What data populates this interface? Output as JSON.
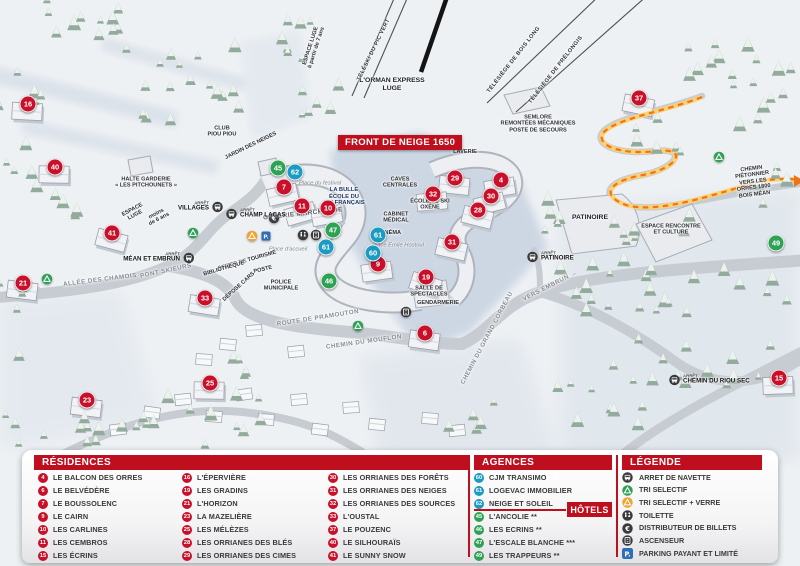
{
  "colors": {
    "red": "#c8102a",
    "blue": "#1b9ac2",
    "green": "#2ea155",
    "header_red": "#bf0f1e",
    "orange_path": "#ee7416",
    "parking_blue": "#2f6db5",
    "icon_dark": "#3a3a3c"
  },
  "map": {
    "banner": "FRONT DE NEIGE 1650",
    "markers": [
      {
        "n": "16",
        "type": "residence",
        "x": 28,
        "y": 104
      },
      {
        "n": "40",
        "type": "residence",
        "x": 55,
        "y": 167
      },
      {
        "n": "41",
        "type": "residence",
        "x": 112,
        "y": 233
      },
      {
        "n": "21",
        "type": "residence",
        "x": 23,
        "y": 283
      },
      {
        "n": "33",
        "type": "residence",
        "x": 205,
        "y": 298
      },
      {
        "n": "23",
        "type": "residence",
        "x": 87,
        "y": 400
      },
      {
        "n": "25",
        "type": "residence",
        "x": 210,
        "y": 383
      },
      {
        "n": "7",
        "type": "residence",
        "x": 284,
        "y": 187
      },
      {
        "n": "11",
        "type": "residence",
        "x": 302,
        "y": 206
      },
      {
        "n": "10",
        "type": "residence",
        "x": 328,
        "y": 208
      },
      {
        "n": "9",
        "type": "residence",
        "x": 378,
        "y": 264
      },
      {
        "n": "19",
        "type": "residence",
        "x": 426,
        "y": 277
      },
      {
        "n": "6",
        "type": "residence",
        "x": 425,
        "y": 333
      },
      {
        "n": "29",
        "type": "residence",
        "x": 455,
        "y": 178
      },
      {
        "n": "32",
        "type": "residence",
        "x": 433,
        "y": 194
      },
      {
        "n": "4",
        "type": "residence",
        "x": 501,
        "y": 180
      },
      {
        "n": "30",
        "type": "residence",
        "x": 491,
        "y": 196
      },
      {
        "n": "28",
        "type": "residence",
        "x": 478,
        "y": 210
      },
      {
        "n": "31",
        "type": "residence",
        "x": 452,
        "y": 242
      },
      {
        "n": "37",
        "type": "residence",
        "x": 639,
        "y": 98
      },
      {
        "n": "15",
        "type": "residence",
        "x": 779,
        "y": 378
      },
      {
        "n": "45",
        "type": "hotel",
        "x": 278,
        "y": 168
      },
      {
        "n": "47",
        "type": "hotel",
        "x": 333,
        "y": 230
      },
      {
        "n": "46",
        "type": "hotel",
        "x": 329,
        "y": 281
      },
      {
        "n": "49",
        "type": "hotel",
        "x": 776,
        "y": 243
      },
      {
        "n": "62",
        "type": "agence",
        "x": 295,
        "y": 172
      },
      {
        "n": "61",
        "type": "agence",
        "x": 326,
        "y": 247
      },
      {
        "n": "61",
        "type": "agence",
        "x": 378,
        "y": 235
      },
      {
        "n": "60",
        "type": "agence",
        "x": 373,
        "y": 253
      }
    ],
    "labels": [
      {
        "t": "ESPACE LUGE\nà partir de 7 ans",
        "x": 314,
        "y": 47,
        "r": -72,
        "c": "tiny"
      },
      {
        "t": "TÉLÉSKI DU PIC VERT",
        "x": 374,
        "y": 50,
        "r": -64,
        "c": "lift"
      },
      {
        "t": "L'ORMAN EXPRESS\nLUGE",
        "x": 392,
        "y": 85,
        "r": 0,
        "c": "poi"
      },
      {
        "t": "TÉLÉSIÈGE DE BOIS LONG",
        "x": 514,
        "y": 60,
        "r": -52,
        "c": "lift"
      },
      {
        "t": "TÉLÉSIÈGE DE PRÉLONGIS",
        "x": 556,
        "y": 70,
        "r": -52,
        "c": "lift"
      },
      {
        "t": "SEMLORE\nREMONTÉES MÉCANIQUES\nPOSTE DE SECOURS",
        "x": 538,
        "y": 124,
        "r": 0,
        "c": "tiny"
      },
      {
        "t": "CLUB\nPIOU PIOU",
        "x": 222,
        "y": 132,
        "r": 0,
        "c": "tiny"
      },
      {
        "t": "JARDIN DES NEIGES",
        "x": 251,
        "y": 146,
        "r": -26,
        "c": "tiny"
      },
      {
        "t": "HALTE GARDERIE\n« LES PITCHOUNETS »",
        "x": 146,
        "y": 183,
        "r": 0,
        "c": "tiny"
      },
      {
        "t": "ESPACE\nLUGE",
        "x": 134,
        "y": 213,
        "r": -28,
        "c": "tiny"
      },
      {
        "t": "moins\nde 6 ans",
        "x": 158,
        "y": 217,
        "r": -28,
        "c": "tiny"
      },
      {
        "t": "LAVERIE",
        "x": 465,
        "y": 152,
        "r": 0,
        "c": "tiny"
      },
      {
        "t": "CAVES\nCENTRALES",
        "x": 400,
        "y": 183,
        "r": 0,
        "c": "tiny"
      },
      {
        "t": "Place du festival",
        "x": 320,
        "y": 184,
        "r": 0,
        "c": "place"
      },
      {
        "t": "LA BULLE\nÉCOLE DU\nSKI FRANÇAIS",
        "x": 344,
        "y": 197,
        "r": 0,
        "c": "esf"
      },
      {
        "t": "GALERIE MARCHANDE",
        "x": 303,
        "y": 214,
        "r": -6,
        "c": "poi-light"
      },
      {
        "t": "ÉCOLE DE SKI\nOXÈNE",
        "x": 430,
        "y": 205,
        "r": 0,
        "c": "tiny"
      },
      {
        "t": "CABINET\nMÉDICAL",
        "x": 396,
        "y": 218,
        "r": 0,
        "c": "tiny"
      },
      {
        "t": "CINÉMA",
        "x": 390,
        "y": 233,
        "r": 0,
        "c": "tiny"
      },
      {
        "t": "Place Émile Hostoul",
        "x": 398,
        "y": 246,
        "r": 0,
        "c": "place"
      },
      {
        "t": "Place d'accueil",
        "x": 288,
        "y": 250,
        "r": 0,
        "c": "place"
      },
      {
        "t": "OFFICE DE TOURISME",
        "x": 247,
        "y": 261,
        "r": -16,
        "c": "tiny"
      },
      {
        "t": "BIBLIOTHÈQUE",
        "x": 224,
        "y": 269,
        "r": -16,
        "c": "tiny"
      },
      {
        "t": "POSTE",
        "x": 263,
        "y": 270,
        "r": -14,
        "c": "tiny"
      },
      {
        "t": "DÉPOSE CARS",
        "x": 239,
        "y": 287,
        "r": -42,
        "c": "tiny"
      },
      {
        "t": "POLICE\nMUNICIPALE",
        "x": 281,
        "y": 286,
        "r": 0,
        "c": "tiny"
      },
      {
        "t": "SALLE DE\nSPECTACLES",
        "x": 429,
        "y": 292,
        "r": 0,
        "c": "tiny"
      },
      {
        "t": "GENDARMERIE",
        "x": 438,
        "y": 303,
        "r": 0,
        "c": "tiny"
      },
      {
        "t": "ROUTE DE PRAMOUTON",
        "x": 318,
        "y": 318,
        "r": -9,
        "c": "road"
      },
      {
        "t": "CHEMIN DU MOUFLON",
        "x": 364,
        "y": 342,
        "r": -8,
        "c": "road"
      },
      {
        "t": "CHEMIN DU GRAND CORBEAU",
        "x": 487,
        "y": 338,
        "r": -62,
        "c": "road"
      },
      {
        "t": "VERS EMBRUN →",
        "x": 550,
        "y": 286,
        "r": -27,
        "c": "road"
      },
      {
        "t": "ALLÉE DES CHAMOIS",
        "x": 100,
        "y": 280,
        "r": -7,
        "c": "road"
      },
      {
        "t": "PONT SKIEURS",
        "x": 166,
        "y": 271,
        "r": -12,
        "c": "road"
      },
      {
        "t": "PATINOIRE",
        "x": 590,
        "y": 218,
        "r": 0,
        "c": "poi"
      },
      {
        "t": "ESPACE RENCONTRE\nET CULTURE",
        "x": 671,
        "y": 230,
        "r": 0,
        "c": "tiny"
      },
      {
        "t": "CHEMIN PIÉTONNIER\nVERS LES ORRES 1800\nBOIS MÉAN",
        "x": 753,
        "y": 182,
        "r": -7,
        "c": "tiny"
      }
    ],
    "bus_stops": [
      {
        "name": "VILLAGES",
        "x": 216,
        "y": 207,
        "side": "left"
      },
      {
        "name": "CHAMP LACAS",
        "x": 233,
        "y": 214,
        "side": "right"
      },
      {
        "name": "MÉAN ET EMBRUN",
        "x": 187,
        "y": 258,
        "side": "left"
      },
      {
        "name": "PATINOIRE",
        "x": 534,
        "y": 257,
        "side": "right"
      },
      {
        "name": "CHEMIN DU RIOU SEC",
        "x": 676,
        "y": 380,
        "side": "right"
      }
    ],
    "icons": [
      {
        "k": "recycle-green",
        "x": 193,
        "y": 233
      },
      {
        "k": "recycle-green",
        "x": 47,
        "y": 279
      },
      {
        "k": "recycle-green",
        "x": 358,
        "y": 326
      },
      {
        "k": "recycle-green",
        "x": 719,
        "y": 157
      },
      {
        "k": "recycle-orange",
        "x": 252,
        "y": 236
      },
      {
        "k": "parking",
        "x": 266,
        "y": 236
      },
      {
        "k": "euro",
        "x": 274,
        "y": 218
      },
      {
        "k": "toilet",
        "x": 303,
        "y": 235
      },
      {
        "k": "elevator",
        "x": 316,
        "y": 235
      },
      {
        "k": "elevator",
        "x": 406,
        "y": 312
      }
    ]
  },
  "panels": {
    "residences": {
      "title": "RÉSIDENCES",
      "items": [
        {
          "n": "4",
          "label": "LE BALCON DES ORRES"
        },
        {
          "n": "6",
          "label": "LE BELVÉDÈRE"
        },
        {
          "n": "7",
          "label": "LE BOUSSOLENC"
        },
        {
          "n": "9",
          "label": "LE CAIRN"
        },
        {
          "n": "10",
          "label": "LES CARLINES"
        },
        {
          "n": "11",
          "label": "LES CEMBROS"
        },
        {
          "n": "15",
          "label": "LES ÉCRINS"
        },
        {
          "n": "16",
          "label": "L'ÉPERVIÈRE"
        },
        {
          "n": "19",
          "label": "LES GRADINS"
        },
        {
          "n": "21",
          "label": "L'HORIZON"
        },
        {
          "n": "23",
          "label": "LA MAZELIÈRE"
        },
        {
          "n": "25",
          "label": "LES MÉLÈZES"
        },
        {
          "n": "28",
          "label": "LES ORRIANES DES BLÉS"
        },
        {
          "n": "29",
          "label": "LES ORRIANES DES CIMES"
        },
        {
          "n": "30",
          "label": "LES ORRIANES DES FORÊTS"
        },
        {
          "n": "31",
          "label": "LES ORRIANES DES NEIGES"
        },
        {
          "n": "32",
          "label": "LES ORRIANES DES SOURCES"
        },
        {
          "n": "33",
          "label": "L'OUSTAL"
        },
        {
          "n": "37",
          "label": "LE POUZENC"
        },
        {
          "n": "40",
          "label": "LE SILHOURAÏS"
        },
        {
          "n": "41",
          "label": "LE SUNNY SNOW"
        }
      ]
    },
    "agences": {
      "title": "AGENCES IMMOBILIÈRES",
      "items": [
        {
          "n": "60",
          "label": "CJM TRANSIMO"
        },
        {
          "n": "61",
          "label": "LOGEVAC IMMOBILIER"
        },
        {
          "n": "62",
          "label": "NEIGE ET SOLEIL"
        }
      ]
    },
    "hotels": {
      "title": "HÔTELS",
      "items": [
        {
          "n": "45",
          "label": "L'ANCOLIE **"
        },
        {
          "n": "46",
          "label": "LES ECRINS **"
        },
        {
          "n": "47",
          "label": "L'ESCALE BLANCHE ***"
        },
        {
          "n": "49",
          "label": "LES TRAPPEURS **"
        }
      ]
    },
    "legende": {
      "title": "LÉGENDE",
      "items": [
        {
          "icon": "bus",
          "label": "ARRET DE NAVETTE"
        },
        {
          "icon": "recycle-green",
          "label": "TRI SELECTIF"
        },
        {
          "icon": "recycle-orange",
          "label": "TRI SELECTIF + VERRE"
        },
        {
          "icon": "toilet",
          "label": "TOILETTE"
        },
        {
          "icon": "euro",
          "label": "DISTRIBUTEUR DE BILLETS"
        },
        {
          "icon": "elevator",
          "label": "ASCENSEUR"
        },
        {
          "icon": "parking",
          "label": "PARKING PAYANT ET LIMITÉ"
        }
      ]
    }
  }
}
